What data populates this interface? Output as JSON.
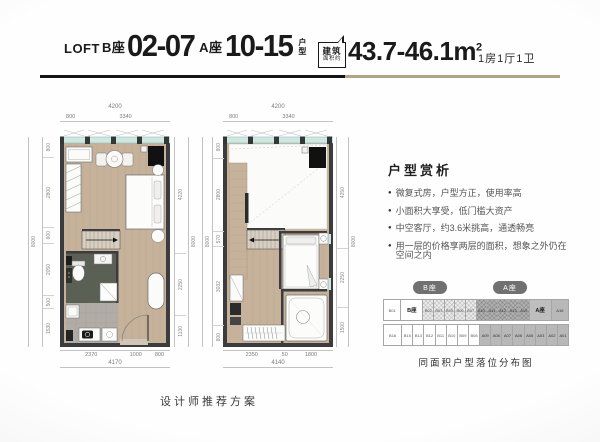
{
  "header": {
    "prefix": "LOFT",
    "b_label": "B座",
    "b_range": "02-07",
    "a_label": "A座",
    "a_range": "10-15",
    "suffix_top": "户",
    "suffix_bottom": "型",
    "badge_line1": "建筑",
    "badge_line2": "面积约",
    "area_value": "43.7-46.1",
    "area_unit": "m",
    "area_sup": "2",
    "rooms": "1房1厅1卫"
  },
  "plans": [
    {
      "top_total": "4200",
      "top_segs": [
        {
          "v": "800",
          "w": 800
        },
        {
          "v": "3340",
          "w": 3340
        }
      ],
      "left_outer": "8000",
      "left_segs": [
        {
          "v": "800",
          "w": 800
        },
        {
          "v": "2800",
          "w": 2800
        },
        {
          "v": "600",
          "w": 600
        },
        {
          "v": "2050",
          "w": 2050
        },
        {
          "v": "500",
          "w": 500
        },
        {
          "v": "1530",
          "w": 1530
        }
      ],
      "right_segs": [
        {
          "v": "4220",
          "w": 4220
        },
        {
          "v": "2250",
          "w": 2250
        },
        {
          "v": "1130",
          "w": 1130
        }
      ],
      "right_outer": "8000",
      "bottom_segs": [
        {
          "v": "2370",
          "w": 2370
        },
        {
          "v": "1000",
          "w": 1000
        },
        {
          "v": "800",
          "w": 800
        }
      ],
      "bottom_total": "4170"
    },
    {
      "top_total": "4200",
      "top_segs": [
        {
          "v": "800",
          "w": 800
        },
        {
          "v": "3340",
          "w": 3340
        }
      ],
      "left_outer": "8000",
      "left_segs": [
        {
          "v": "800",
          "w": 800
        },
        {
          "v": "2800",
          "w": 2800
        },
        {
          "v": "570",
          "w": 570
        },
        {
          "v": "3032",
          "w": 3032
        },
        {
          "v": "800",
          "w": 800
        }
      ],
      "right_segs": [
        {
          "v": "4250",
          "w": 4250
        },
        {
          "v": "2250",
          "w": 2250
        },
        {
          "v": "1500",
          "w": 1500
        }
      ],
      "right_outer": "8000",
      "bottom_segs": [
        {
          "v": "2350",
          "w": 2350
        },
        {
          "v": "50",
          "w": 350
        },
        {
          "v": "1800",
          "w": 1800
        }
      ],
      "bottom_total": "4140"
    }
  ],
  "analysis": {
    "title": "户型赏析",
    "bullet_icon": "●",
    "bullets": [
      "微复式房，户型方正，使用率高",
      "小面积大享受，低门槛大资产",
      "中空客厅，约3.6米挑高，通透畅亮",
      "用一层的价格享两层的面积，想象之外仍在空间之内"
    ]
  },
  "distribution": {
    "pill_b": "B座",
    "pill_a": "A座",
    "top_row": [
      {
        "label": "B01",
        "w": 1.7,
        "cls": "plain"
      },
      {
        "label": "B座",
        "w": 2.2,
        "cls": "label-b"
      },
      {
        "label": "B02",
        "w": 1,
        "cls": "hatch-light"
      },
      {
        "label": "B03",
        "w": 1,
        "cls": "hatch-light"
      },
      {
        "label": "B05",
        "w": 1,
        "cls": "hatch-light"
      },
      {
        "label": "B06",
        "w": 1,
        "cls": "hatch-light"
      },
      {
        "label": "B07",
        "w": 1,
        "cls": "hatch-light"
      },
      {
        "label": "A10",
        "w": 1,
        "cls": "hatch-dark"
      },
      {
        "label": "A11",
        "w": 1,
        "cls": "hatch-dark"
      },
      {
        "label": "A12",
        "w": 1,
        "cls": "hatch-dark"
      },
      {
        "label": "A13",
        "w": 1,
        "cls": "hatch-dark"
      },
      {
        "label": "A15",
        "w": 1,
        "cls": "hatch-dark"
      },
      {
        "label": "A座",
        "w": 2.2,
        "cls": "label-a"
      },
      {
        "label": "A16",
        "w": 1.7,
        "cls": "dark"
      }
    ],
    "bottom_row": [
      {
        "label": "B16",
        "w": 1.7,
        "cls": "plain"
      },
      {
        "label": "B15",
        "w": 1,
        "cls": "plain"
      },
      {
        "label": "B13",
        "w": 1,
        "cls": "plain"
      },
      {
        "label": "B12",
        "w": 1,
        "cls": "plain"
      },
      {
        "label": "B11",
        "w": 1,
        "cls": "plain"
      },
      {
        "label": "B10",
        "w": 1,
        "cls": "plain"
      },
      {
        "label": "B09",
        "w": 1,
        "cls": "plain"
      },
      {
        "label": "B08",
        "w": 1,
        "cls": "plain"
      },
      {
        "label": "A09",
        "w": 1,
        "cls": "dark"
      },
      {
        "label": "A08",
        "w": 1,
        "cls": "dark"
      },
      {
        "label": "A07",
        "w": 1,
        "cls": "dark"
      },
      {
        "label": "A06",
        "w": 1,
        "cls": "dark"
      },
      {
        "label": "A05",
        "w": 1,
        "cls": "dark"
      },
      {
        "label": "A03",
        "w": 1,
        "cls": "dark"
      },
      {
        "label": "A02",
        "w": 1,
        "cls": "dark"
      },
      {
        "label": "A01",
        "w": 1,
        "cls": "dark"
      }
    ],
    "caption": "同面积户型落位分布图"
  },
  "footer": {
    "note": "设计师推荐方案"
  },
  "colors": {
    "accent_tan": "#b5a286",
    "ink": "#141418",
    "wall": "#3c3c3e",
    "wood_floor": "#c6b19a",
    "window_glass": "#cde7e2",
    "bathroom_floor": "#5a6053",
    "kitchen_floor": "#b1ada6",
    "highlight_light": "#ececec",
    "highlight_dark": "#b1b1b1"
  }
}
